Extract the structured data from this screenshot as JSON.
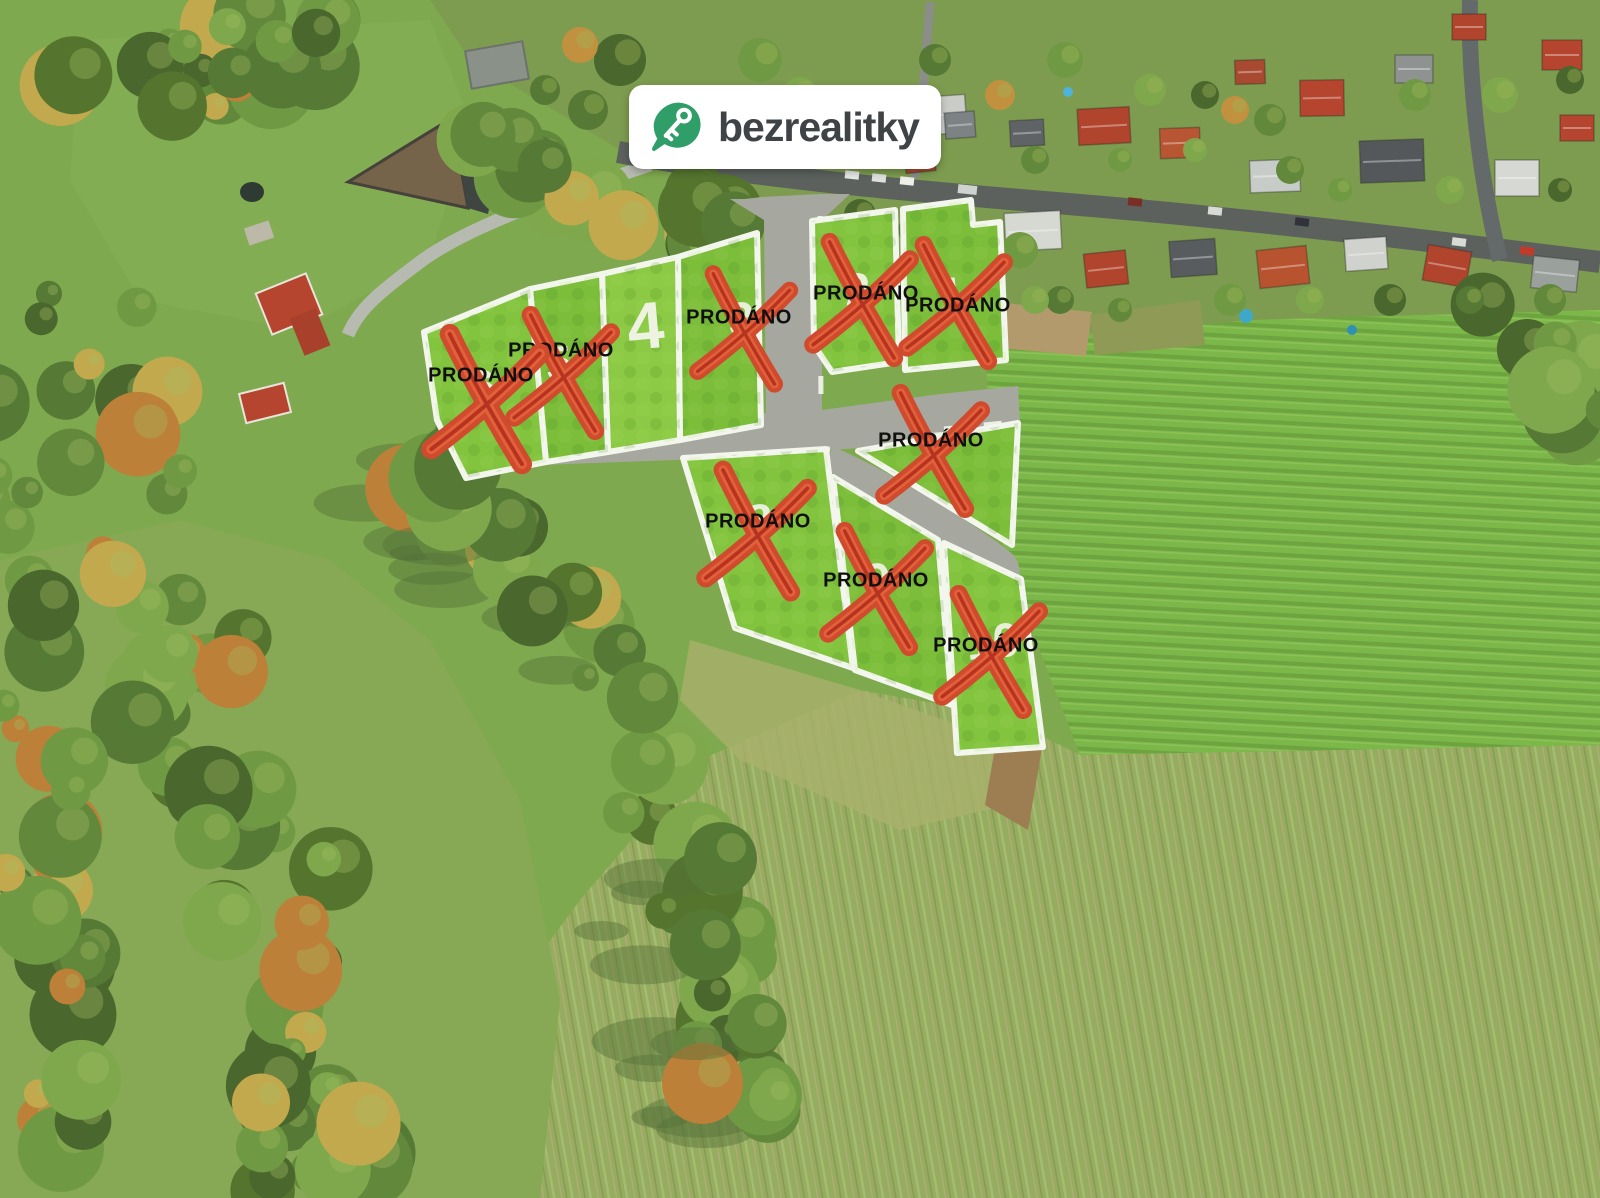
{
  "page": {
    "title": "Aerial view of building plots for sale",
    "width": 1600,
    "height": 1198
  },
  "badge": {
    "brand": "bezrealitky",
    "icon": "map-pin-key-icon"
  },
  "overlay": {
    "sold_label": "PRODÁNO",
    "plots": [
      {
        "id": "plot-1",
        "number": "1",
        "status": "sold",
        "label": "PRODÁNO",
        "lx": 958,
        "ly": 306,
        "cx": 956,
        "cy": 302,
        "nx": 952,
        "ny": 298,
        "xs": 1.0
      },
      {
        "id": "plot-2",
        "number": "2",
        "status": "sold",
        "label": "PRODÁNO",
        "lx": 866,
        "ly": 294,
        "cx": 862,
        "cy": 299,
        "nx": 858,
        "ny": 294,
        "xs": 1.0
      },
      {
        "id": "plot-3",
        "number": "3",
        "status": "sold",
        "label": "PRODÁNO",
        "lx": 739,
        "ly": 318,
        "cx": 744,
        "cy": 328,
        "nx": 742,
        "ny": 323,
        "xs": 0.95
      },
      {
        "id": "plot-4",
        "number": "4",
        "status": "available",
        "nx": 646,
        "ny": 331
      },
      {
        "id": "plot-5",
        "number": "5",
        "status": "sold",
        "label": "PRODÁNO",
        "lx": 561,
        "ly": 351,
        "cx": 563,
        "cy": 372,
        "nx": 559,
        "ny": 367,
        "xs": 1.0
      },
      {
        "id": "plot-6",
        "number": "6",
        "status": "sold",
        "label": "PRODÁNO",
        "lx": 481,
        "ly": 376,
        "cx": 486,
        "cy": 398,
        "nx": 483,
        "ny": 391,
        "xs": 1.12
      },
      {
        "id": "plot-7",
        "number": "7",
        "status": "sold",
        "label": "PRODÁNO",
        "lx": 931,
        "ly": 441,
        "cx": 933,
        "cy": 450,
        "nx": 936,
        "ny": 453,
        "xs": 1.0
      },
      {
        "id": "plot-8",
        "number": "8",
        "status": "sold",
        "label": "PRODÁNO",
        "lx": 758,
        "ly": 522,
        "cx": 757,
        "cy": 530,
        "nx": 760,
        "ny": 525,
        "xs": 1.05
      },
      {
        "id": "plot-9",
        "number": "9",
        "status": "sold",
        "label": "PRODÁNO",
        "lx": 876,
        "ly": 581,
        "cx": 877,
        "cy": 588,
        "nx": 878,
        "ny": 584,
        "xs": 1.0
      },
      {
        "id": "plot-10",
        "number": "10",
        "status": "sold",
        "label": "PRODÁNO",
        "lx": 986,
        "ly": 646,
        "cx": 991,
        "cy": 651,
        "nx": 993,
        "ny": 645,
        "xs": 1.0
      }
    ]
  },
  "colors": {
    "plot_green": "#83c43f",
    "plot_green_alt": "#7cbd3a",
    "plot_available": "#8cc944",
    "plot_border": "#f3f6ec",
    "road_overlay": "#a6a8a0",
    "village_road": "#5c615e",
    "access_road": "#b7bab0",
    "x_red": "#d04a2e",
    "x_red_light": "#e2603a",
    "x_red_dark": "#b5331f",
    "label_black": "#101010",
    "number_white": "#f3f5ea",
    "badge_bg": "#ffffff",
    "badge_text": "#3f4346",
    "badge_green": "#2f9e68"
  }
}
